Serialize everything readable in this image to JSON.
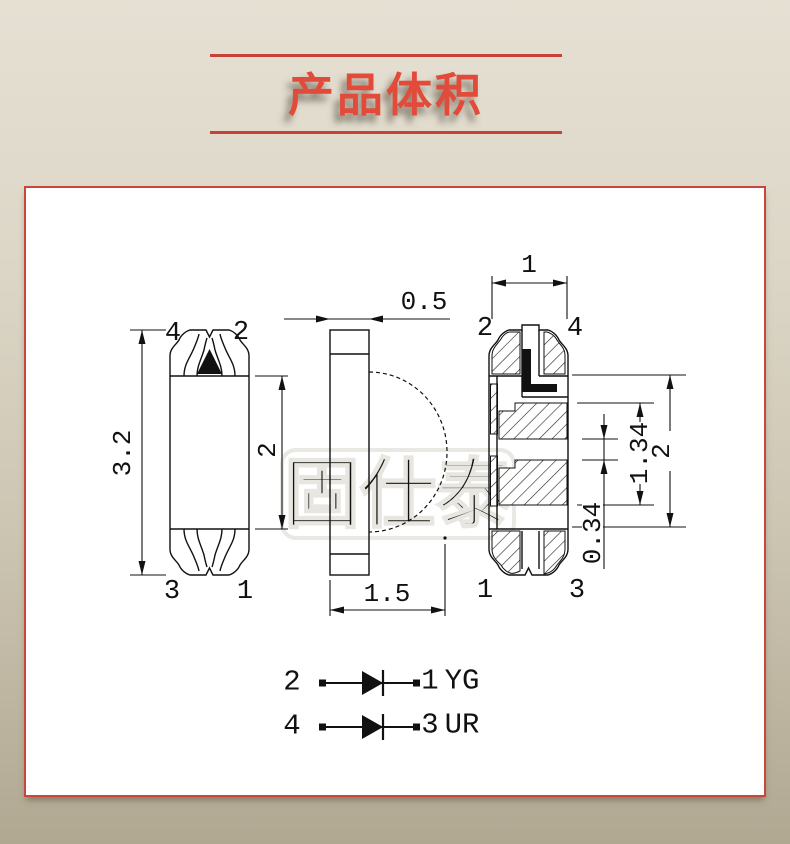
{
  "title": {
    "text": "产品体积"
  },
  "watermark": {
    "text": "固仕泰"
  },
  "top_view": {
    "pin_tl": "4",
    "pin_tr": "2",
    "pin_bl": "3",
    "pin_br": "1",
    "dim_overall": "3.2",
    "dim_body": "2"
  },
  "side_view": {
    "dim_thickness": "0.5",
    "dim_total": "1.5"
  },
  "back_view": {
    "pin_tl": "2",
    "pin_tr": "4",
    "pin_bl": "1",
    "pin_br": "3",
    "dim_width": "1",
    "dim_outer": "2",
    "dim_inner": "1.34",
    "dim_pad": "0.34"
  },
  "circuit": {
    "rows": [
      {
        "anode_pin": "2",
        "cathode_pin": "1",
        "color_code": "YG"
      },
      {
        "anode_pin": "4",
        "cathode_pin": "3",
        "color_code": "UR"
      }
    ]
  },
  "colors": {
    "accent_red": "#c84136",
    "title_red": "#e24a39",
    "line_black": "#111111"
  }
}
